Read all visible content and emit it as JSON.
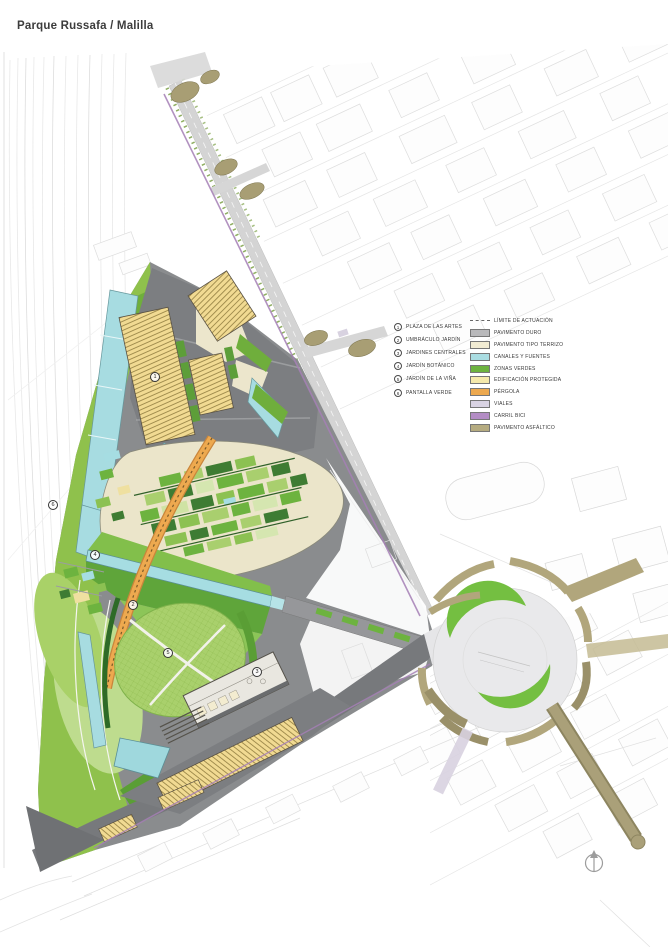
{
  "title": "Parque Russafa / Malilla",
  "legend": {
    "numbered": [
      {
        "num": "1",
        "label": "PLAZA DE LAS ARTES"
      },
      {
        "num": "2",
        "label": "UMBRÁCULO JARDÍN"
      },
      {
        "num": "3",
        "label": "JARDINES CENTRALES"
      },
      {
        "num": "4",
        "label": "JARDÍN BOTÁNICO"
      },
      {
        "num": "5",
        "label": "JARDÍN DE LA VIÑA"
      },
      {
        "num": "6",
        "label": "PANTALLA VERDE"
      }
    ],
    "swatches": [
      {
        "type": "dash",
        "color": "#8a8a8a",
        "label": "LÍMITE DE ACTUACIÓN"
      },
      {
        "type": "fill",
        "color": "#b9b9bb",
        "label": "PAVIMENTO DURO"
      },
      {
        "type": "fill",
        "color": "#f2ecd3",
        "label": "PAVIMENTO TIPO TERRIZO"
      },
      {
        "type": "fill",
        "color": "#aadde2",
        "label": "CANALES Y FUENTES"
      },
      {
        "type": "fill",
        "color": "#6db33f",
        "label": "ZONAS VERDES"
      },
      {
        "type": "fill",
        "color": "#f5e9ab",
        "label": "EDIFICACIÓN PROTEGIDA"
      },
      {
        "type": "fill",
        "color": "#eda94f",
        "label": "PÉRGOLA"
      },
      {
        "type": "fill",
        "color": "#d9d3e3",
        "label": "VIALES"
      },
      {
        "type": "fill",
        "color": "#b38cc4",
        "label": "CARRIL BICI"
      },
      {
        "type": "fill",
        "color": "#b5ab80",
        "label": "PAVIMENTO ASFÁLTICO"
      }
    ]
  },
  "markers": [
    "1",
    "2",
    "3",
    "4",
    "5",
    "6"
  ]
}
